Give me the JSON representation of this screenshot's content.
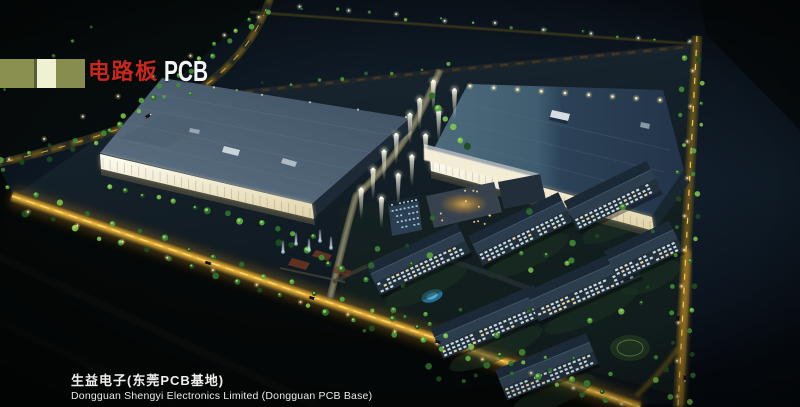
{
  "header": {
    "category_cn": "电路板",
    "category_en": "PCB"
  },
  "caption": {
    "line1": "生益电子(东莞PCB基地)",
    "line2": "Dongguan Shengyi Electronics Limited (Dongguan PCB Base)"
  },
  "palette": {
    "title_red": "#c8281b",
    "title_white": "#f3f5f7",
    "bar_olive": "#8a9150",
    "bar_olive_dark": "#555c33",
    "bar_cream": "#eff1d2",
    "caption_white": "#f0f0ee",
    "sky_dark": "#070d12",
    "roof_blue_light": "#4d6b7c",
    "roof_blue_dark": "#27394c",
    "facade_warm": "#f7f3e0",
    "road_glow": "#d89b26",
    "road_centerline": "#ffd34d",
    "tree_green": "#3f8f37",
    "window_cool": "#d9e8f0",
    "window_warm": "#f3e2b0"
  }
}
